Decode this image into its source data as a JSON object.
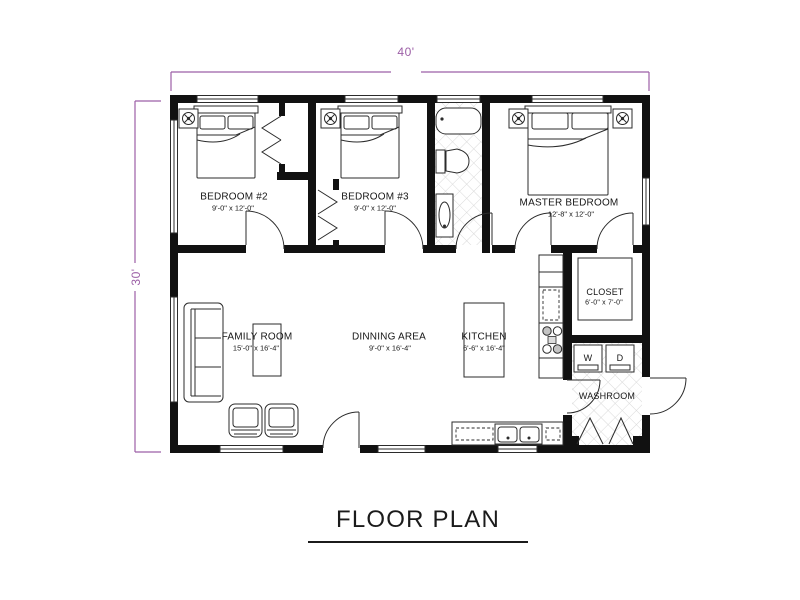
{
  "title": "FLOOR PLAN",
  "dimensions": {
    "width": "40'",
    "depth": "30'"
  },
  "rooms": {
    "bedroom2": {
      "name": "BEDROOM #2",
      "size": "9'-0\" x 12'-0\""
    },
    "bedroom3": {
      "name": "BEDROOM #3",
      "size": "9'-0\" x 12'-0\""
    },
    "master_bedroom": {
      "name": "MASTER BEDROOM",
      "size": "12'-8\" x 12'-0\""
    },
    "family_room": {
      "name": "FAMILY ROOM",
      "size": "15'-0\" x 16'-4\""
    },
    "dining_area": {
      "name": "DINNING AREA",
      "size": "9'-0\" x 16'-4\""
    },
    "kitchen": {
      "name": "KITCHEN",
      "size": "6'-6\" x 16'-4\""
    },
    "closet": {
      "name": "CLOSET",
      "size": "6'-0\" x 7'-0\""
    },
    "washroom": {
      "name": "WASHROOM"
    }
  },
  "appliances": {
    "washer_label": "W",
    "dryer_label": "D"
  },
  "colors": {
    "dimension_line": "#9c5fa6",
    "wall": "#111111",
    "furniture_line": "#2b2b2b"
  }
}
